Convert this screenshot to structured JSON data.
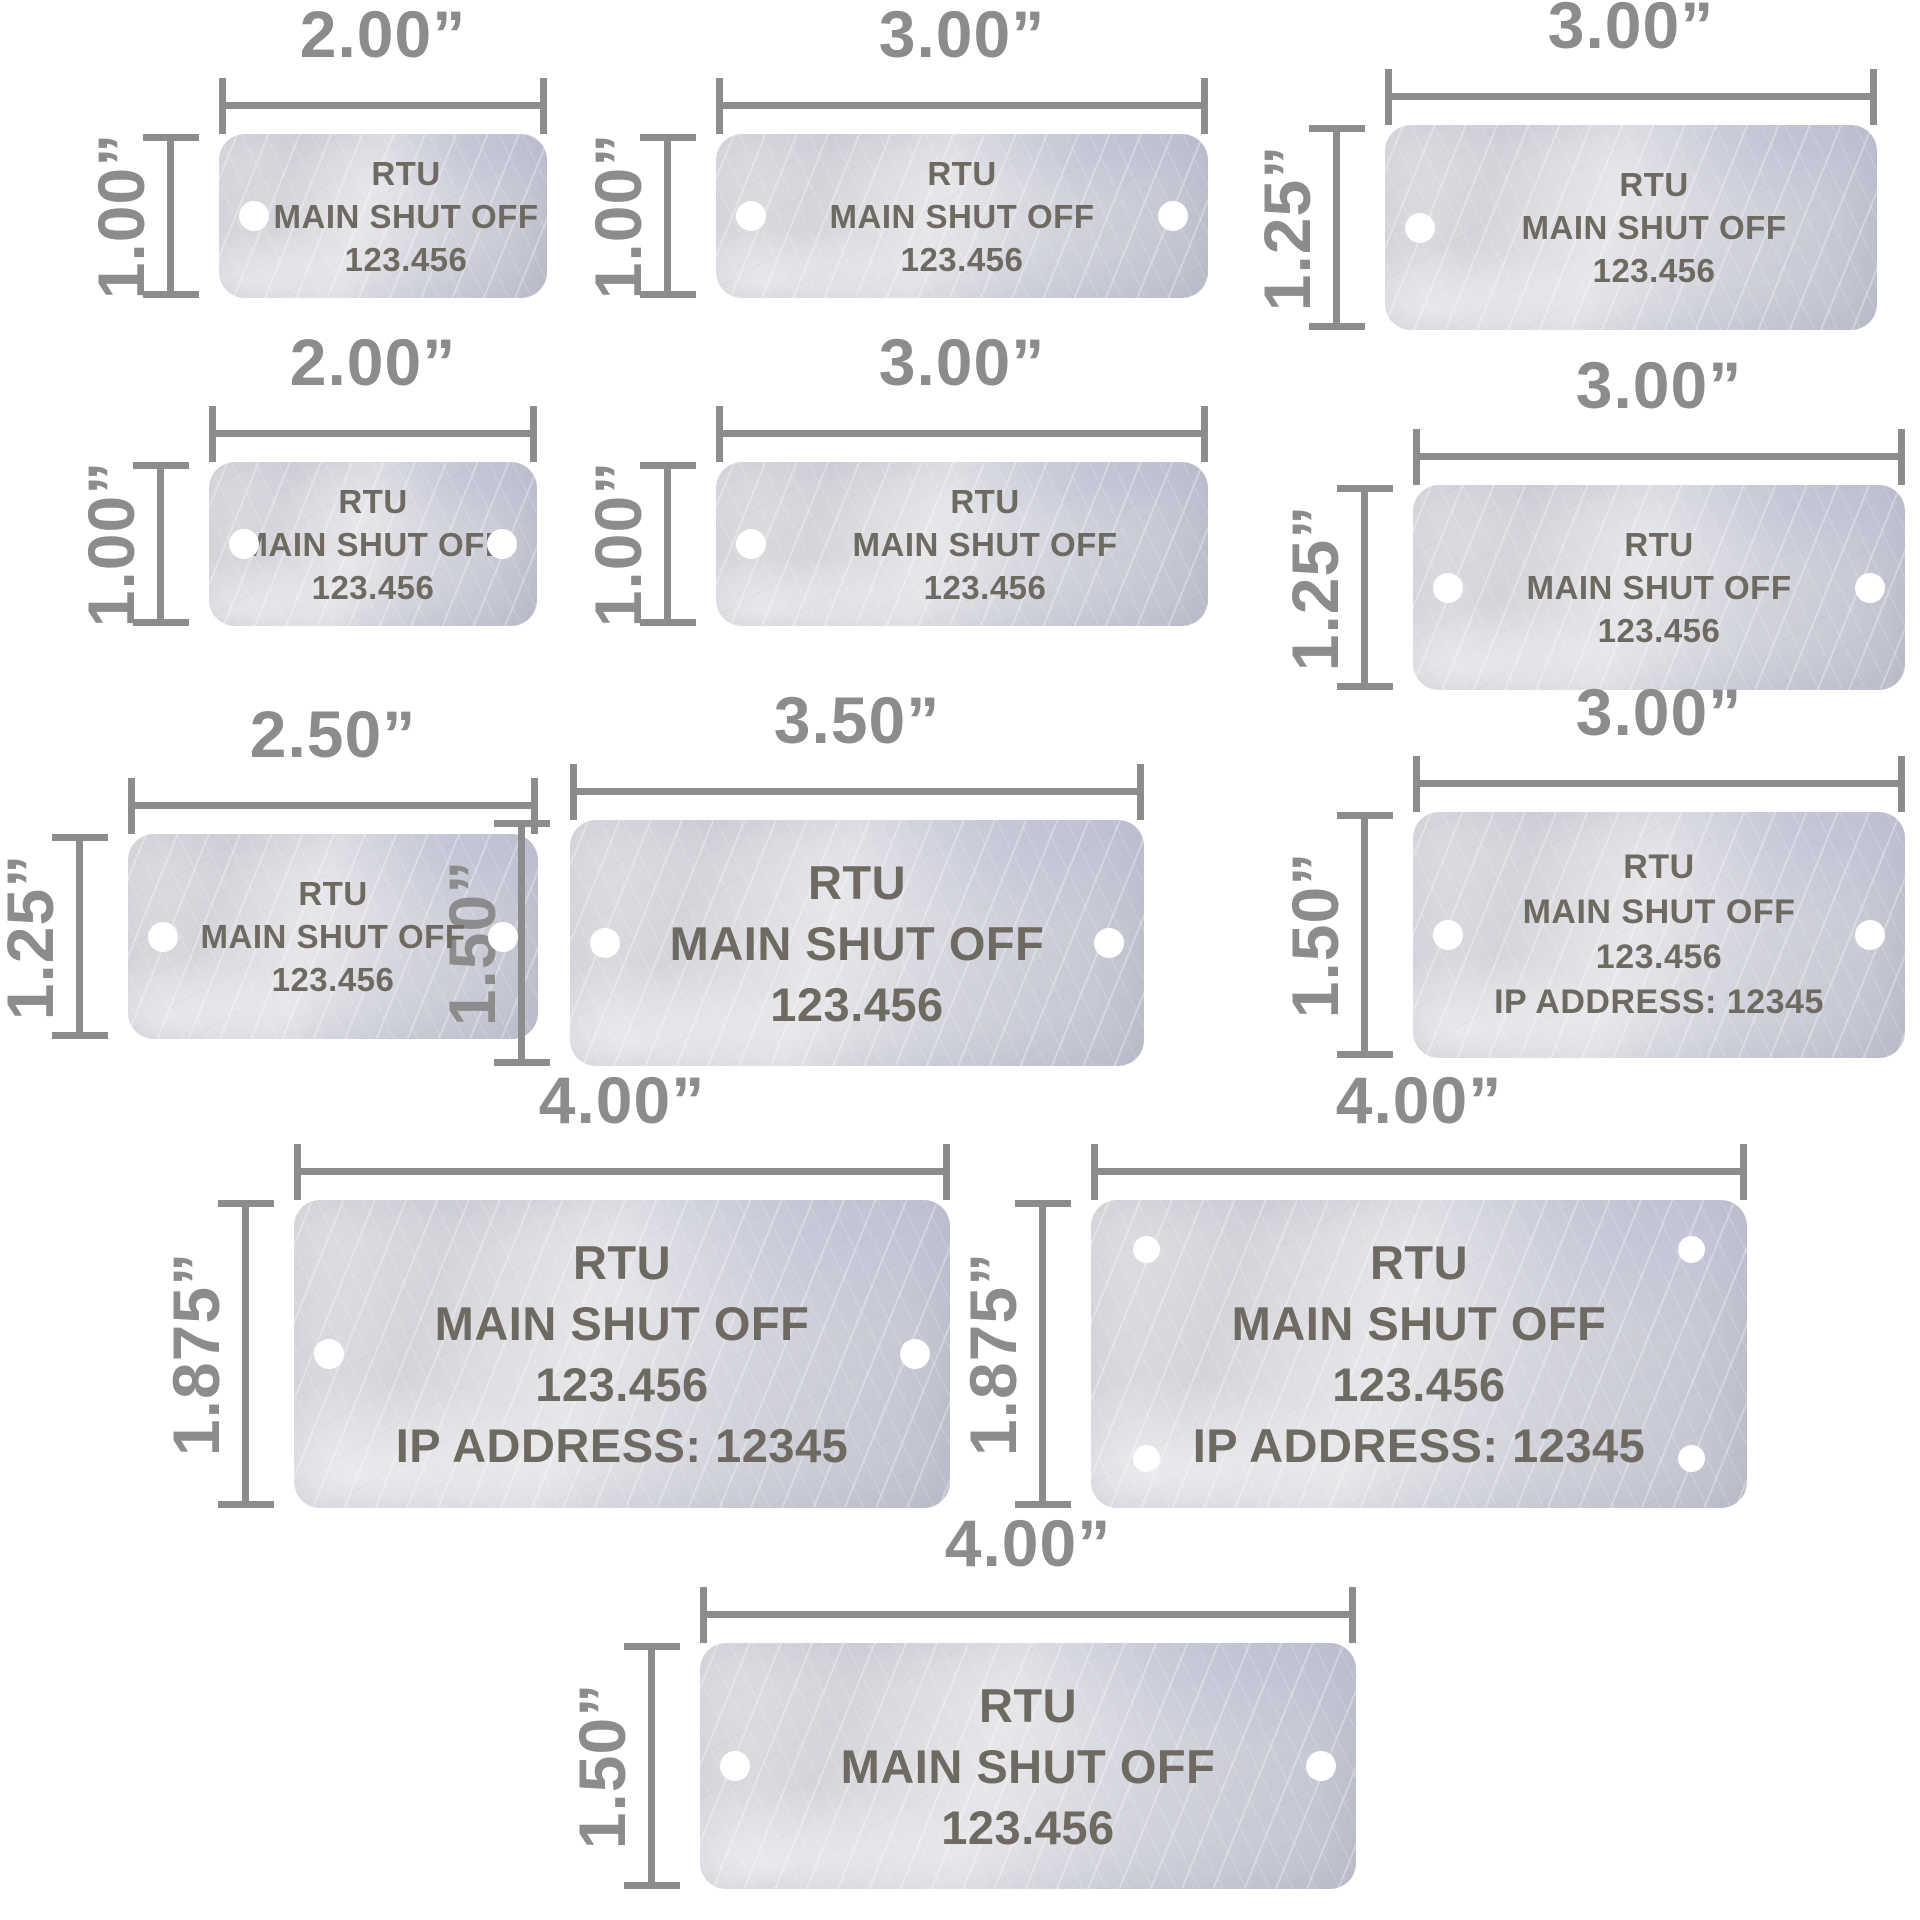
{
  "styles": {
    "dimension_color": "#8c8c8c",
    "engraving_color": "#6e6a61",
    "plate_color": "#d6d7de",
    "hole_color": "#ffffff"
  },
  "tags": [
    {
      "width_label": "2.00”",
      "height_label": "1.00”",
      "holes": "left",
      "lines": [
        "RTU",
        "MAIN SHUT OFF",
        "123.456"
      ]
    },
    {
      "width_label": "3.00”",
      "height_label": "1.00”",
      "holes": "left-right",
      "lines": [
        "RTU",
        "MAIN SHUT OFF",
        "123.456"
      ]
    },
    {
      "width_label": "3.00”",
      "height_label": "1.25”",
      "holes": "left",
      "lines": [
        "RTU",
        "MAIN SHUT OFF",
        "123.456"
      ]
    },
    {
      "width_label": "2.00”",
      "height_label": "1.00”",
      "holes": "left-right",
      "lines": [
        "RTU",
        "MAIN SHUT OFF",
        "123.456"
      ]
    },
    {
      "width_label": "3.00”",
      "height_label": "1.00”",
      "holes": "left",
      "lines": [
        "RTU",
        "MAIN SHUT OFF",
        "123.456"
      ]
    },
    {
      "width_label": "3.00”",
      "height_label": "1.25”",
      "holes": "left-right",
      "lines": [
        "RTU",
        "MAIN SHUT OFF",
        "123.456"
      ]
    },
    {
      "width_label": "2.50”",
      "height_label": "1.25”",
      "holes": "left-right",
      "lines": [
        "RTU",
        "MAIN SHUT OFF",
        "123.456"
      ]
    },
    {
      "width_label": "3.50”",
      "height_label": "1.50”",
      "holes": "left-right",
      "lines": [
        "RTU",
        "MAIN SHUT OFF",
        "123.456"
      ]
    },
    {
      "width_label": "3.00”",
      "height_label": "1.50”",
      "holes": "left-right",
      "lines": [
        "RTU",
        "MAIN SHUT OFF",
        "123.456",
        "IP ADDRESS: 12345"
      ]
    },
    {
      "width_label": "4.00”",
      "height_label": "1.875”",
      "holes": "left-right",
      "lines": [
        "RTU",
        "MAIN SHUT OFF",
        "123.456",
        "IP ADDRESS: 12345"
      ]
    },
    {
      "width_label": "4.00”",
      "height_label": "1.875”",
      "holes": "four-corners",
      "lines": [
        "RTU",
        "MAIN SHUT OFF",
        "123.456",
        "IP ADDRESS: 12345"
      ]
    },
    {
      "width_label": "4.00”",
      "height_label": "1.50”",
      "holes": "left-right",
      "lines": [
        "RTU",
        "MAIN SHUT OFF",
        "123.456"
      ]
    }
  ]
}
